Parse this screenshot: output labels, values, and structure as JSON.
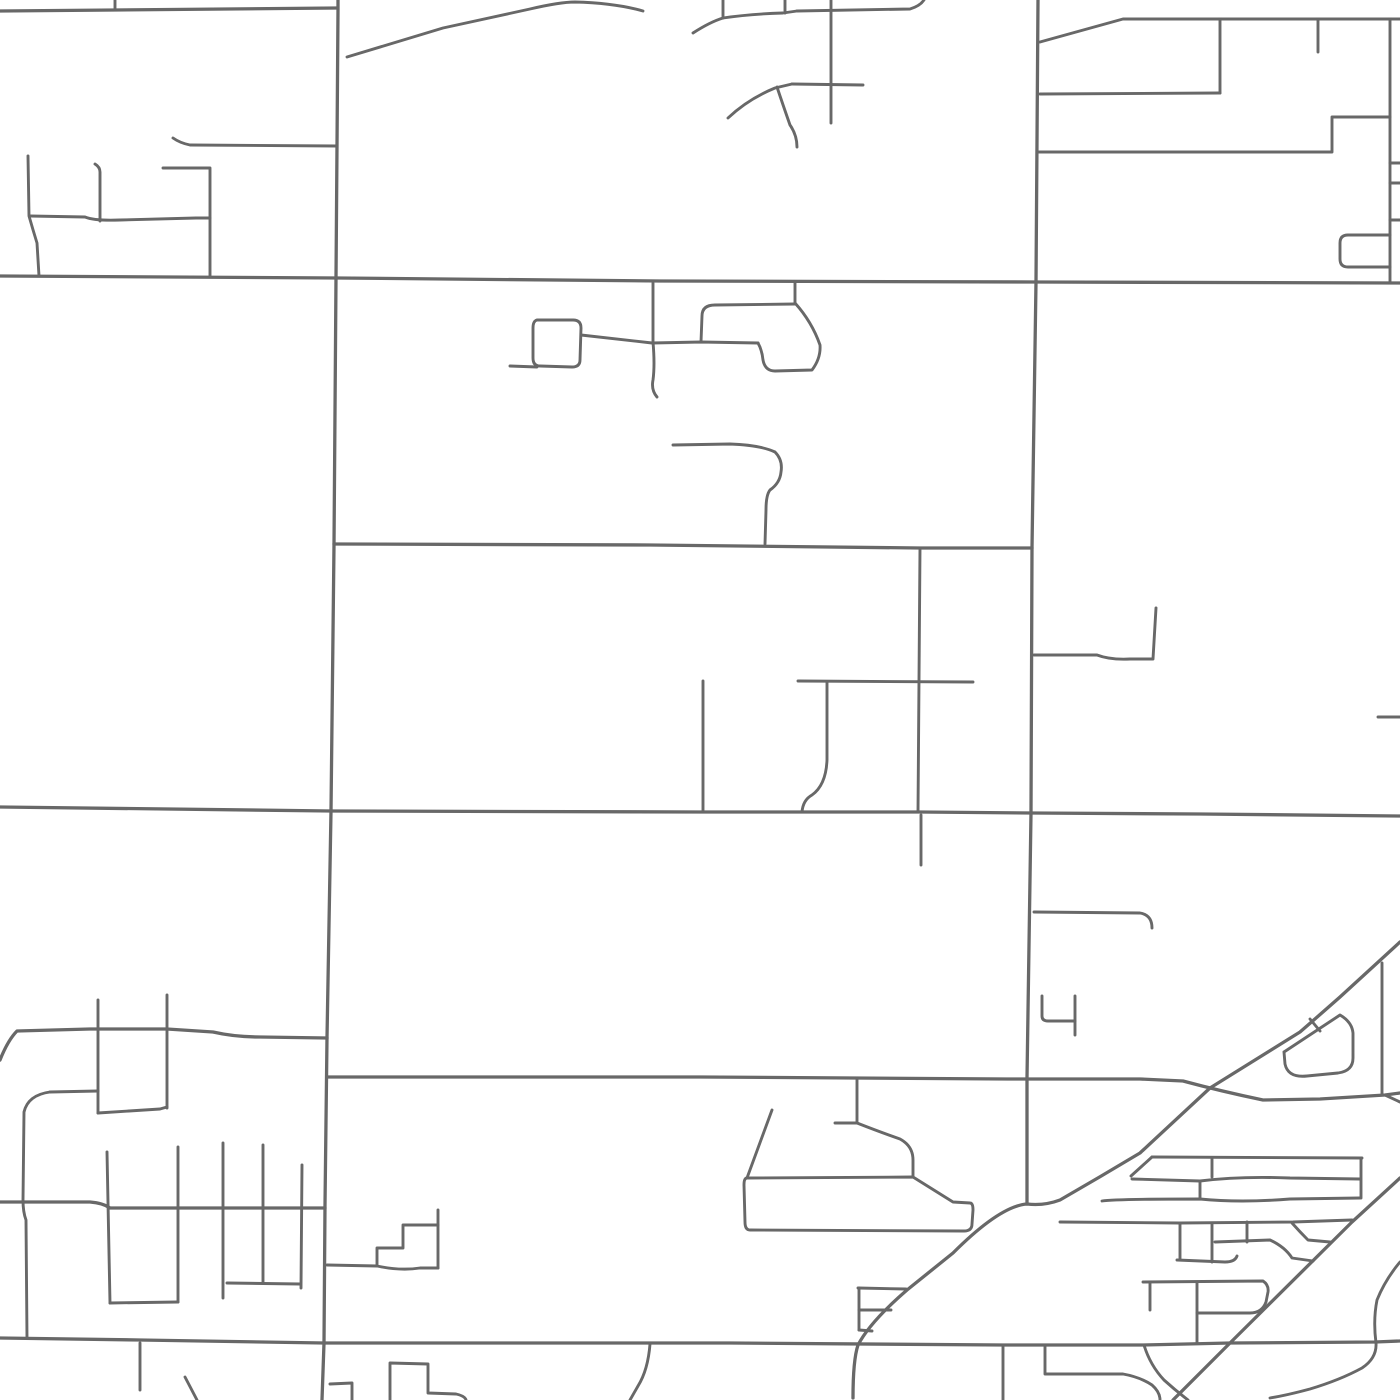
{
  "map": {
    "background": "#ffffff",
    "road_color": "#686868",
    "major_road_width": 3.3,
    "minor_road_width": 2.9,
    "viewport": {
      "width": 1400,
      "height": 1400
    },
    "roads": [
      {
        "id": "arterial-north",
        "class": "major",
        "d": "M0,11 L115,10 L337,8"
      },
      {
        "id": "arterial-upper",
        "class": "major",
        "d": "M0,276 L338,278 L660,281 L1036,282 L1400,283"
      },
      {
        "id": "arterial-lower",
        "class": "major",
        "d": "M0,807 L331,811 L700,812 L920,812 L1031,813 L1200,814 L1400,816"
      },
      {
        "id": "arterial-south",
        "class": "major",
        "d": "M0,1338 L140,1340 L324,1343 L730,1343 L1003,1345 L1143,1345 L1230,1343 L1375,1342 L1400,1341"
      },
      {
        "id": "section-vertical-west",
        "class": "major",
        "d": "M338,0 L338,10 L337,146 L336,278 L334,545 L331,811 L327,1038 L325,1205 L324,1343 L322,1400"
      },
      {
        "id": "section-vertical-east",
        "class": "major",
        "d": "M1038,0 L1036,282 L1032,548 L1031,813 L1027,1078 L1027,1204"
      },
      {
        "id": "road-mid-545",
        "class": "major",
        "d": "M334,544 L650,545 L920,548 L1032,548"
      },
      {
        "id": "road-1030-west",
        "class": "major",
        "d": "M0,1060 Q8,1040 17,1031 L90,1029 L167,1029 L213,1032 Q235,1037 260,1037 L327,1038"
      },
      {
        "id": "road-1077-cross",
        "class": "major",
        "d": "M328,1077 L700,1077 L1007,1079 L1140,1079 L1183,1081 Q1220,1091 1263,1100 L1320,1099 L1385,1095 L1400,1093"
      },
      {
        "id": "road-1077-fork",
        "class": "minor",
        "d": "M1385,1095 L1400,1102"
      },
      {
        "id": "road-1205-west",
        "class": "major",
        "d": "M0,1202 L90,1202 Q103,1203 110,1208 L240,1208 L325,1208"
      },
      {
        "id": "diagonal-rail-main",
        "class": "major",
        "d": "M1400,942 L1340,997 Q1315,1019 1300,1032 L1210,1088 L1140,1153 Q1100,1177 1060,1200 Q1044,1206 1027,1204 Q1000,1206 953,1253 L907,1290 Q870,1322 858,1345 Q853,1360 853,1398"
      },
      {
        "id": "diagonal-rail-second",
        "class": "major",
        "d": "M1400,1178 L1352,1222 L1230,1343 L1173,1400"
      },
      {
        "id": "nw-tick-top",
        "class": "minor",
        "d": "M115,0 L115,10"
      },
      {
        "id": "nw-lane-vert-a",
        "class": "minor",
        "d": "M28,156 L29,216 Q33,230 37,243 L39,276"
      },
      {
        "id": "nw-lane-horiz",
        "class": "minor",
        "d": "M30,216 L85,217 Q95,221 120,220 L196,218 L210,218"
      },
      {
        "id": "nw-lane-vert-b",
        "class": "minor",
        "d": "M95,164 Q100,167 100,172 L100,221"
      },
      {
        "id": "nw-bracket",
        "class": "minor",
        "d": "M163,168 L210,168 L210,277"
      },
      {
        "id": "nw-road-146",
        "class": "minor",
        "d": "M173,138 Q180,143 190,145 L337,146"
      },
      {
        "id": "n-diagonal-lane",
        "class": "minor",
        "d": "M347,57 L443,28 L530,9 Q560,2 575,2 Q615,3 643,11"
      },
      {
        "id": "n-wavy-lane",
        "class": "minor",
        "d": "M693,33 Q710,22 723,18 Q750,14 783,13 L797,11"
      },
      {
        "id": "n-top-lane",
        "class": "minor",
        "d": "M797,11 L910,9 Q920,6 924,0"
      },
      {
        "id": "n-tick-723",
        "class": "minor",
        "d": "M723,0 L723,18"
      },
      {
        "id": "n-tick-785",
        "class": "minor",
        "d": "M785,0 L785,13"
      },
      {
        "id": "n-cross-vert",
        "class": "minor",
        "d": "M831,0 L831,123"
      },
      {
        "id": "n-cross-horiz",
        "class": "minor",
        "d": "M792,84 L863,85"
      },
      {
        "id": "n-curve-lane",
        "class": "minor",
        "d": "M728,118 Q748,99 775,88 L792,84"
      },
      {
        "id": "n-squiggle-branch",
        "class": "minor",
        "d": "M777,87 Q783,105 790,125 Q797,135 797,147"
      },
      {
        "id": "ne-top-road",
        "class": "minor",
        "d": "M1040,42 L1123,19 L1318,19 L1400,19"
      },
      {
        "id": "ne-vert-1220",
        "class": "minor",
        "d": "M1220,19 L1220,93"
      },
      {
        "id": "ne-horiz-94",
        "class": "minor",
        "d": "M1040,94 L1220,93"
      },
      {
        "id": "ne-tick-1318",
        "class": "minor",
        "d": "M1318,19 L1318,52"
      },
      {
        "id": "ne-vert-east",
        "class": "minor",
        "d": "M1390,19 L1390,283"
      },
      {
        "id": "ne-zigzag-152",
        "class": "minor",
        "d": "M1038,152 L1332,152 L1332,117 L1390,117"
      },
      {
        "id": "ne-edge-tick-163",
        "class": "minor",
        "d": "M1390,163 L1400,163"
      },
      {
        "id": "ne-edge-tick-183",
        "class": "minor",
        "d": "M1390,183 L1400,183"
      },
      {
        "id": "ne-edge-tick-220",
        "class": "minor",
        "d": "M1390,220 L1400,220"
      },
      {
        "id": "ne-loop-rect",
        "class": "minor",
        "d": "M1390,235 L1348,235 Q1340,235 1340,243 L1340,259 Q1340,267 1348,267 L1390,267"
      },
      {
        "id": "mid-stub-366",
        "class": "minor",
        "d": "M510,366 L537,367"
      },
      {
        "id": "mid-rounded-square",
        "class": "minor",
        "d": "M537,320 L573,320 Q581,320 581,328 L580,360 Q580,367 572,367 L540,366 Q533,366 533,358 L533,328 Q533,321 537,320"
      },
      {
        "id": "mid-link-342",
        "class": "minor",
        "d": "M581,335 L652,343 L701,342 L758,343"
      },
      {
        "id": "mid-vert-653",
        "class": "minor",
        "d": "M653,283 L653,342 Q655,365 653,380 Q651,390 657,397"
      },
      {
        "id": "mid-hook-vert",
        "class": "minor",
        "d": "M795,283 L795,303"
      },
      {
        "id": "mid-hook-arm",
        "class": "minor",
        "d": "M795,304 L715,305 Q702,305 702,316 L701,342"
      },
      {
        "id": "mid-blob-loop",
        "class": "minor",
        "d": "M795,303 Q812,322 820,345 Q821,358 812,370 L775,371 Q765,371 763,360 Q762,350 758,343"
      },
      {
        "id": "mid-handle-lane",
        "class": "minor",
        "d": "M673,445 L730,444 Q760,445 775,452 Q783,460 781,472 Q780,483 770,490 Q766,495 766,510 L765,544"
      },
      {
        "id": "c-vert-920",
        "class": "minor",
        "d": "M920,548 L918,812"
      },
      {
        "id": "c-vert-920-south",
        "class": "minor",
        "d": "M921,815 L921,865"
      },
      {
        "id": "c-horiz-682",
        "class": "minor",
        "d": "M798,681 L973,682"
      },
      {
        "id": "c-vert-703",
        "class": "minor",
        "d": "M703,681 L703,812"
      },
      {
        "id": "c-squiggle-827",
        "class": "minor",
        "d": "M827,682 L827,760 Q826,785 812,795 Q803,800 802,812"
      },
      {
        "id": "c-hook-655",
        "class": "minor",
        "d": "M1034,655 L1097,655 Q1110,660 1130,659 L1153,659 L1156,608"
      },
      {
        "id": "e-edge-tick-717",
        "class": "minor",
        "d": "M1378,717 L1400,717"
      },
      {
        "id": "e-hook-912",
        "class": "minor",
        "d": "M1034,912 L1140,913 Q1152,915 1152,928"
      },
      {
        "id": "e-cup-left",
        "class": "minor",
        "d": "M1042,996 L1042,1016 Q1042,1021 1048,1021 L1075,1021"
      },
      {
        "id": "e-cup-right",
        "class": "minor",
        "d": "M1075,996 L1075,1035"
      },
      {
        "id": "sw-vert-a",
        "class": "minor",
        "d": "M98,1000 L98,1113"
      },
      {
        "id": "sw-vert-b",
        "class": "minor",
        "d": "M167,995 L167,1108"
      },
      {
        "id": "sw-u-connector",
        "class": "minor",
        "d": "M98,1113 L160,1109 L167,1107"
      },
      {
        "id": "sw-horiz-1090",
        "class": "minor",
        "d": "M50,1092 L98,1091"
      },
      {
        "id": "sw-loop-west",
        "class": "minor",
        "d": "M50,1092 Q28,1095 24,1112 L23,1200 Q23,1212 26,1220 L27,1338"
      },
      {
        "id": "comb-vert-1",
        "class": "minor",
        "d": "M107,1152 L110,1303"
      },
      {
        "id": "comb-vert-2",
        "class": "minor",
        "d": "M178,1147 L178,1302"
      },
      {
        "id": "comb-u-bottom",
        "class": "minor",
        "d": "M110,1303 L178,1302"
      },
      {
        "id": "comb-vert-3",
        "class": "minor",
        "d": "M223,1143 L223,1298"
      },
      {
        "id": "comb-vert-4",
        "class": "minor",
        "d": "M263,1145 L263,1283"
      },
      {
        "id": "comb-vert-5",
        "class": "minor",
        "d": "M302,1165 L301,1288"
      },
      {
        "id": "comb-connector",
        "class": "minor",
        "d": "M227,1283 L300,1284"
      },
      {
        "id": "steps-base",
        "class": "minor",
        "d": "M327,1265 L377,1266 Q400,1271 420,1268 L438,1268"
      },
      {
        "id": "steps-risers",
        "class": "minor",
        "d": "M377,1265 L377,1248 L403,1248 L403,1225 L438,1225"
      },
      {
        "id": "steps-vert",
        "class": "minor",
        "d": "M438,1210 L438,1268"
      },
      {
        "id": "s-vert-140",
        "class": "minor",
        "d": "M140,1343 L140,1390"
      },
      {
        "id": "s-diag-185",
        "class": "minor",
        "d": "M185,1377 L197,1400"
      },
      {
        "id": "s-lane-352",
        "class": "minor",
        "d": "M330,1384 L352,1383 L352,1400"
      },
      {
        "id": "s-block-390",
        "class": "minor",
        "d": "M390,1400 L390,1363 L428,1364 L428,1393 L456,1394 Q465,1396 466,1400"
      },
      {
        "id": "s-diag-640",
        "class": "minor",
        "d": "M650,1344 Q648,1370 638,1386 L630,1400"
      },
      {
        "id": "boot-vert-857",
        "class": "minor",
        "d": "M857,1078 L857,1123"
      },
      {
        "id": "boot-stub",
        "class": "minor",
        "d": "M835,1123 L857,1123"
      },
      {
        "id": "boot-curve",
        "class": "minor",
        "d": "M857,1123 Q880,1132 900,1139 Q913,1146 913,1160 L913,1177"
      },
      {
        "id": "boot-antenna",
        "class": "minor",
        "d": "M772,1110 L747,1178"
      },
      {
        "id": "boot-block",
        "class": "minor",
        "d": "M747,1178 L913,1177 L953,1202 L970,1203 Q973,1203 973,1210 L972,1224 Q972,1231 964,1231 L750,1230 Q745,1230 745,1222 L744,1185 Q744,1178 747,1178"
      },
      {
        "id": "tri-block-top",
        "class": "minor",
        "d": "M858,1288 L906,1289"
      },
      {
        "id": "tri-block-left",
        "class": "minor",
        "d": "M859,1288 L859,1330"
      },
      {
        "id": "tri-block-mid",
        "class": "minor",
        "d": "M859,1310 L891,1310"
      },
      {
        "id": "tri-block-bottom",
        "class": "minor",
        "d": "M859,1330 L872,1331"
      },
      {
        "id": "se-pentagon",
        "class": "minor",
        "d": "M1284,1052 L1340,1015 Q1352,1022 1353,1033 L1353,1058 Q1353,1071 1338,1073 L1307,1076 Q1288,1078 1285,1064 L1284,1052"
      },
      {
        "id": "se-pent-connector",
        "class": "minor",
        "d": "M1310,1019 L1320,1031"
      },
      {
        "id": "se-vert-1382",
        "class": "minor",
        "d": "M1382,963 L1382,1095"
      },
      {
        "id": "se-row-1",
        "class": "minor",
        "d": "M1152,1157 L1362,1158"
      },
      {
        "id": "se-row-2",
        "class": "minor",
        "d": "M1132,1179 L1200,1181 Q1240,1176 1290,1178 L1360,1179"
      },
      {
        "id": "se-row-3",
        "class": "minor",
        "d": "M1102,1201 Q1115,1199 1200,1199 Q1240,1203 1290,1199 L1360,1198"
      },
      {
        "id": "se-row-left-close",
        "class": "minor",
        "d": "M1152,1157 L1131,1176"
      },
      {
        "id": "se-row-div-a",
        "class": "minor",
        "d": "M1212,1158 L1212,1177"
      },
      {
        "id": "se-row-div-b",
        "class": "minor",
        "d": "M1200,1182 L1200,1199"
      },
      {
        "id": "se-row-right-vert",
        "class": "minor",
        "d": "M1361,1158 L1361,1198"
      },
      {
        "id": "se-street-1222",
        "class": "minor",
        "d": "M1060,1222 L1180,1223 L1293,1222 L1352,1220"
      },
      {
        "id": "se-vert-1180",
        "class": "minor",
        "d": "M1180,1223 L1180,1260"
      },
      {
        "id": "se-vert-1212",
        "class": "minor",
        "d": "M1212,1223 L1212,1262"
      },
      {
        "id": "se-street-1260",
        "class": "minor",
        "d": "M1177,1260 L1225,1262 Q1235,1262 1237,1256"
      },
      {
        "id": "se-tick-1247",
        "class": "minor",
        "d": "M1247,1222 L1247,1242"
      },
      {
        "id": "se-street-1242",
        "class": "minor",
        "d": "M1215,1242 L1270,1240 Q1285,1247 1292,1258 L1313,1261"
      },
      {
        "id": "se-zig-street",
        "class": "minor",
        "d": "M1292,1223 Q1300,1232 1308,1240 L1330,1242"
      },
      {
        "id": "se-p-block",
        "class": "minor",
        "d": "M1143,1282 L1263,1281 Q1269,1285 1268,1292 L1266,1302 Q1262,1313 1250,1313 L1197,1313"
      },
      {
        "id": "se-p-block-vert",
        "class": "minor",
        "d": "M1197,1282 L1197,1343"
      },
      {
        "id": "se-tick-1150",
        "class": "minor",
        "d": "M1150,1282 L1150,1310"
      },
      {
        "id": "s-vert-1003",
        "class": "minor",
        "d": "M1003,1345 L1003,1400"
      },
      {
        "id": "s-vert-1045",
        "class": "minor",
        "d": "M1045,1345 L1045,1373"
      },
      {
        "id": "s-lane-1374",
        "class": "minor",
        "d": "M1045,1374 L1123,1374 Q1140,1377 1152,1385 Q1160,1392 1160,1400"
      },
      {
        "id": "s-curve-1144",
        "class": "minor",
        "d": "M1144,1345 Q1150,1365 1164,1380 Q1175,1390 1188,1400"
      },
      {
        "id": "se-swoosh-ramp",
        "class": "minor",
        "d": "M1400,1262 Q1385,1280 1377,1300 Q1373,1320 1376,1343 Q1377,1358 1362,1368 Q1340,1380 1310,1389 Q1288,1395 1270,1398"
      }
    ]
  }
}
